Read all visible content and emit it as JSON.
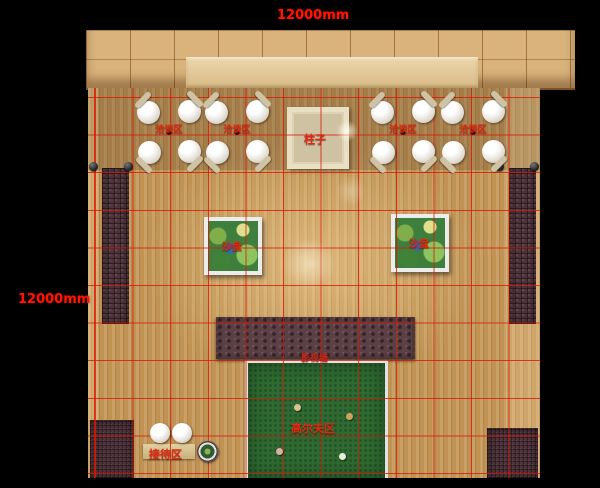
{
  "dimensions": {
    "top": "12000mm",
    "left": "12000mm"
  },
  "areas": {
    "pillar": "柱子",
    "negotiation": "洽谈区",
    "sand_table": "沙盘",
    "media_wall": "影视墙",
    "golf": "高尔夫区",
    "reception": "接待区"
  },
  "colors": {
    "background": "#000000",
    "dimension_text": "#ff1500",
    "area_label_text": "#e02a12",
    "grid_line": "#d7190a",
    "floor_wood": "#c09355",
    "tile_walkway": "#d9b37b",
    "brick_path": "#4e343c",
    "media_wall": "#5b4046",
    "golf_green": "#2e6a31",
    "sand_table_green": "#3e7f3e"
  }
}
